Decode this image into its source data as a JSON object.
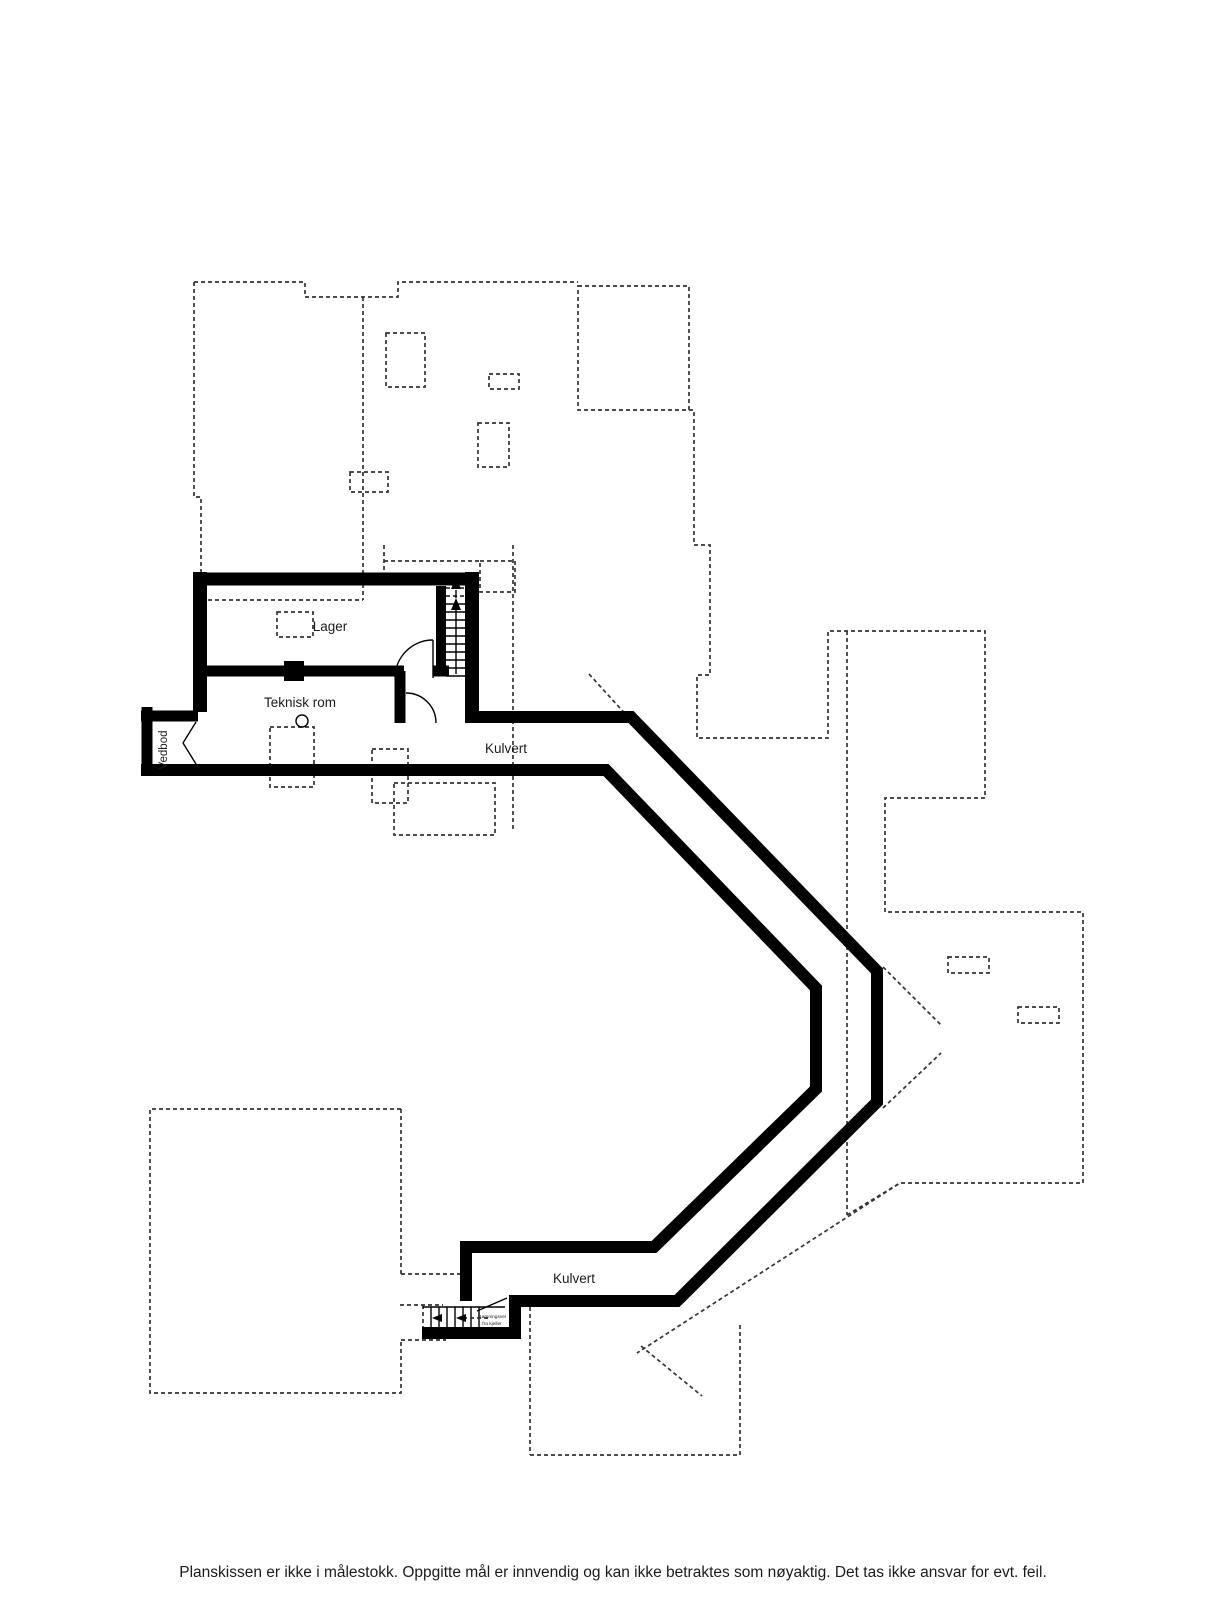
{
  "floorplan": {
    "rooms": {
      "lager": "Lager",
      "teknisk_rom": "Teknisk rom",
      "vedbod": "Vedbod",
      "kulvert_upper": "Kulvert",
      "kulvert_lower": "Kulvert"
    },
    "escape_stair_note": {
      "line1": "Rømningsvei",
      "line2": "fra kjeller"
    },
    "disclaimer": "Planskissen er ikke i målestokk. Oppgitte mål er innvendig og kan ikke betraktes som nøyaktig. Det tas ikke ansvar for evt. feil.",
    "colors": {
      "wall": "#000000",
      "dashed_outline": "#333333",
      "text": "#1b1b1b",
      "background": "#ffffff"
    }
  }
}
